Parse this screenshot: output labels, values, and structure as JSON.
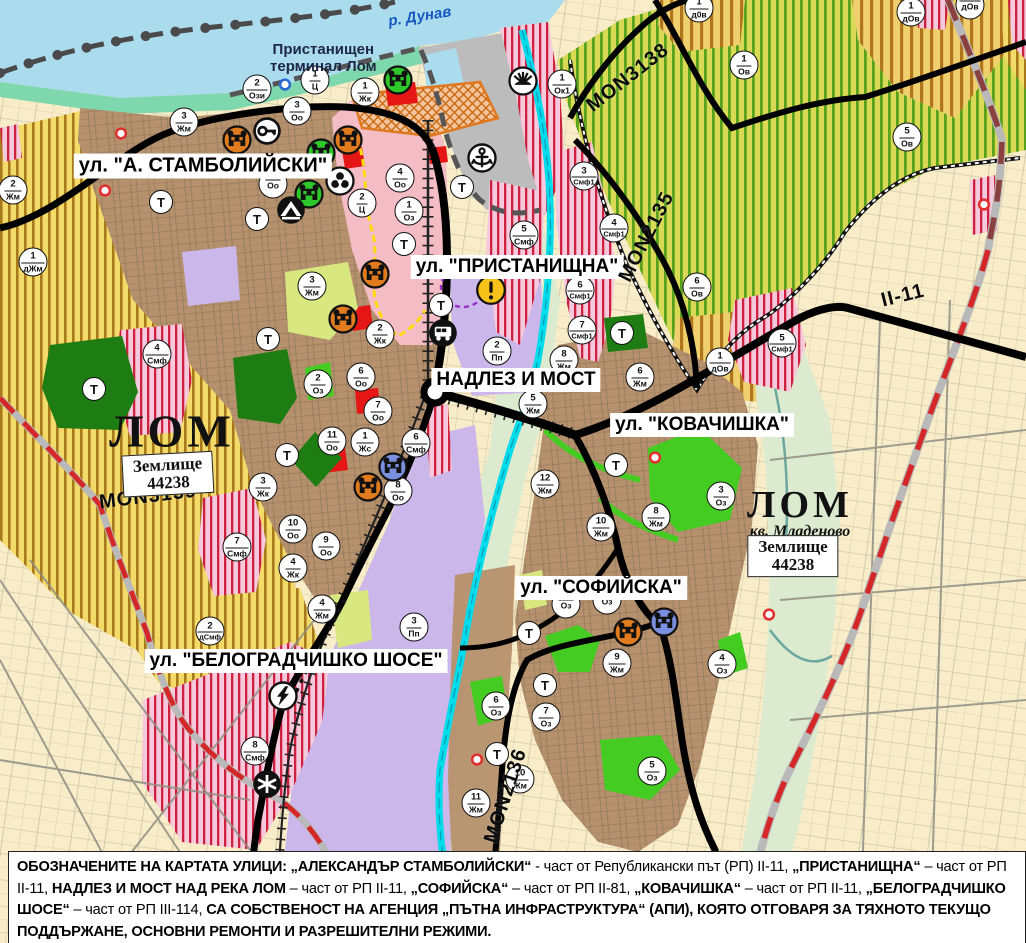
{
  "map_title": "Устройствен план на гр. Лом",
  "colors": {
    "water": "#aadcee",
    "river_cyan": "#00dcec",
    "coast_strip": "#7fd7ad",
    "city_brown": "#b6916d",
    "lavender_production": "#cbb7ea",
    "beige_farmland": "#f8edc8",
    "port_gray": "#bcbcbc",
    "center_pink": "#f4bcc4",
    "green_area": "#44cc22",
    "park_green": "#1e7d12",
    "pale_green": "#d8e77f",
    "floodplain": "#dcebcf",
    "red_accent": "#e51616",
    "yellow_zone": "#f3da69",
    "yellow_stripe": "#a87a1b",
    "vine_green_stripe": "#5aa21d",
    "smf_red_stripe": "#ce2140",
    "boundary_red": "#d42727",
    "historic_orange": "#e07820"
  },
  "water_label": {
    "text": "р. Дунав"
  },
  "port_label": {
    "line1": "Пристанищен",
    "line2": "терминал Лом"
  },
  "city_labels": [
    {
      "name": "ЛОМ",
      "sub": "",
      "x": 172,
      "y": 431,
      "size": 46
    },
    {
      "name": "ЛОМ",
      "sub": "кв. Младеново",
      "x": 800,
      "y": 512,
      "size": 38
    }
  ],
  "land_boxes": [
    {
      "line1": "Землище",
      "line2": "44238",
      "x": 168,
      "y": 474,
      "rot": -3
    },
    {
      "line1": "Землище",
      "line2": "44238",
      "x": 793,
      "y": 556,
      "rot": 0
    }
  ],
  "street_labels": [
    {
      "text": "ул. \"А. СТАМБОЛИЙСКИ\"",
      "x": 203,
      "y": 166,
      "fs": 20
    },
    {
      "text": "ул. \"ПРИСТАНИЩНА\"",
      "x": 517,
      "y": 267,
      "fs": 19
    },
    {
      "text": "НАДЛЕЗ И МОСТ",
      "x": 516,
      "y": 380,
      "fs": 19
    },
    {
      "text": "ул. \"КОВАЧИШКА\"",
      "x": 702,
      "y": 425,
      "fs": 19
    },
    {
      "text": "ул. \"СОФИЙСКА\"",
      "x": 601,
      "y": 588,
      "fs": 19
    },
    {
      "text": "ул. \"БЕЛОГРАДЧИШКО ШОСЕ\"",
      "x": 296,
      "y": 661,
      "fs": 19
    }
  ],
  "road_labels": [
    {
      "text": "MON3138",
      "x": 628,
      "y": 78,
      "rot": -38
    },
    {
      "text": "MON2135",
      "x": 647,
      "y": 237,
      "rot": -63
    },
    {
      "text": "MON3139",
      "x": 148,
      "y": 497,
      "rot": -7
    },
    {
      "text": "MON2136",
      "x": 506,
      "y": 796,
      "rot": -72
    },
    {
      "text": "II-11",
      "x": 903,
      "y": 296,
      "rot": -14
    }
  ],
  "zone_markers": [
    {
      "num": "2",
      "code": "Ози",
      "x": 257,
      "y": 89
    },
    {
      "num": "1",
      "code": "Ц",
      "x": 315,
      "y": 80
    },
    {
      "num": "1",
      "code": "Жк",
      "x": 365,
      "y": 92
    },
    {
      "num": "3",
      "code": "Оо",
      "x": 297,
      "y": 111
    },
    {
      "num": "3",
      "code": "Жм",
      "x": 184,
      "y": 122
    },
    {
      "num": "2",
      "code": "Жм",
      "x": 13,
      "y": 190
    },
    {
      "num": "1",
      "code": "дЖм",
      "x": 33,
      "y": 262
    },
    {
      "num": "4",
      "code": "Оо",
      "x": 400,
      "y": 178
    },
    {
      "num": "2",
      "code": "Ц",
      "x": 362,
      "y": 203
    },
    {
      "num": "1",
      "code": "Оз",
      "x": 409,
      "y": 211
    },
    {
      "num": "",
      "code": "Оо",
      "x": 273,
      "y": 184
    },
    {
      "num": "3",
      "code": "Жм",
      "x": 312,
      "y": 286
    },
    {
      "num": "1",
      "code": "Ок1",
      "x": 562,
      "y": 84
    },
    {
      "num": "3",
      "code": "Смф1",
      "x": 584,
      "y": 176
    },
    {
      "num": "4",
      "code": "Смф1",
      "x": 614,
      "y": 228
    },
    {
      "num": "5",
      "code": "Смф",
      "x": 524,
      "y": 235
    },
    {
      "num": "1",
      "code": "Ов",
      "x": 744,
      "y": 65
    },
    {
      "num": "5",
      "code": "Ов",
      "x": 907,
      "y": 137
    },
    {
      "num": "1",
      "code": "д0в",
      "x": 699,
      "y": 8
    },
    {
      "num": "1",
      "code": "дОв",
      "x": 911,
      "y": 12
    },
    {
      "num": "",
      "code": "дОв",
      "x": 970,
      "y": 5
    },
    {
      "num": "6",
      "code": "Ов",
      "x": 697,
      "y": 287
    },
    {
      "num": "1",
      "code": "дОв",
      "x": 720,
      "y": 362
    },
    {
      "num": "5",
      "code": "Смф1",
      "x": 782,
      "y": 343
    },
    {
      "num": "6",
      "code": "Смф1",
      "x": 580,
      "y": 290
    },
    {
      "num": "7",
      "code": "Смф1",
      "x": 582,
      "y": 330
    },
    {
      "num": "2",
      "code": "Пп",
      "x": 497,
      "y": 351
    },
    {
      "num": "8",
      "code": "Жм",
      "x": 564,
      "y": 360
    },
    {
      "num": "4",
      "code": "Смф",
      "x": 157,
      "y": 354
    },
    {
      "num": "2",
      "code": "Оз",
      "x": 318,
      "y": 384
    },
    {
      "num": "6",
      "code": "Оо",
      "x": 361,
      "y": 377
    },
    {
      "num": "2",
      "code": "Жк",
      "x": 380,
      "y": 334
    },
    {
      "num": "7",
      "code": "Оо",
      "x": 378,
      "y": 411
    },
    {
      "num": "11",
      "code": "Оо",
      "x": 332,
      "y": 441
    },
    {
      "num": "1",
      "code": "Жс",
      "x": 365,
      "y": 442
    },
    {
      "num": "6",
      "code": "Смф",
      "x": 416,
      "y": 443
    },
    {
      "num": "8",
      "code": "Оо",
      "x": 398,
      "y": 491
    },
    {
      "num": "3",
      "code": "Жк",
      "x": 263,
      "y": 487
    },
    {
      "num": "10",
      "code": "Оо",
      "x": 293,
      "y": 529
    },
    {
      "num": "9",
      "code": "Оо",
      "x": 326,
      "y": 546
    },
    {
      "num": "4",
      "code": "Жк",
      "x": 293,
      "y": 568
    },
    {
      "num": "7",
      "code": "Смф",
      "x": 237,
      "y": 547
    },
    {
      "num": "5",
      "code": "Жм",
      "x": 533,
      "y": 404
    },
    {
      "num": "6",
      "code": "Жм",
      "x": 640,
      "y": 377
    },
    {
      "num": "12",
      "code": "Жм",
      "x": 545,
      "y": 484
    },
    {
      "num": "10",
      "code": "Жм",
      "x": 601,
      "y": 527
    },
    {
      "num": "8",
      "code": "Жм",
      "x": 656,
      "y": 517
    },
    {
      "num": "3",
      "code": "Оз",
      "x": 721,
      "y": 496
    },
    {
      "num": "2",
      "code": "дСмф",
      "x": 210,
      "y": 631
    },
    {
      "num": "4",
      "code": "Жм",
      "x": 322,
      "y": 609
    },
    {
      "num": "3",
      "code": "Пп",
      "x": 414,
      "y": 627
    },
    {
      "num": "8",
      "code": "Смф",
      "x": 255,
      "y": 751
    },
    {
      "num": "",
      "code": "Оз",
      "x": 566,
      "y": 604
    },
    {
      "num": "",
      "code": "Оз",
      "x": 607,
      "y": 600
    },
    {
      "num": "6",
      "code": "Оз",
      "x": 496,
      "y": 706
    },
    {
      "num": "7",
      "code": "Оз",
      "x": 546,
      "y": 717
    },
    {
      "num": "9",
      "code": "Жм",
      "x": 617,
      "y": 663
    },
    {
      "num": "10",
      "code": "Жм",
      "x": 520,
      "y": 779
    },
    {
      "num": "11",
      "code": "Жм",
      "x": 476,
      "y": 803
    },
    {
      "num": "5",
      "code": "Оз",
      "x": 652,
      "y": 771
    },
    {
      "num": "4",
      "code": "Оз",
      "x": 722,
      "y": 664
    }
  ],
  "t_markers": {
    "label": "Т",
    "points": [
      [
        161,
        202
      ],
      [
        257,
        219
      ],
      [
        404,
        244
      ],
      [
        462,
        187
      ],
      [
        268,
        339
      ],
      [
        94,
        389
      ],
      [
        287,
        455
      ],
      [
        441,
        305
      ],
      [
        622,
        333
      ],
      [
        616,
        465
      ],
      [
        529,
        633
      ],
      [
        545,
        685
      ],
      [
        497,
        754
      ]
    ]
  },
  "icon_markers": [
    {
      "type": "monument",
      "name": "cultural-monument-icon",
      "color": "orange",
      "x": 237,
      "y": 140
    },
    {
      "type": "monument",
      "name": "cultural-monument-icon",
      "color": "orange",
      "x": 348,
      "y": 140
    },
    {
      "type": "monument",
      "name": "cultural-monument-icon",
      "color": "green",
      "x": 321,
      "y": 153
    },
    {
      "type": "monument",
      "name": "cultural-monument-icon",
      "color": "green",
      "x": 309,
      "y": 194
    },
    {
      "type": "monument",
      "name": "cultural-monument-icon",
      "color": "green",
      "x": 398,
      "y": 80
    },
    {
      "type": "monument",
      "name": "cultural-monument-icon",
      "color": "orange",
      "x": 375,
      "y": 274
    },
    {
      "type": "monument",
      "name": "cultural-monument-icon",
      "color": "orange",
      "x": 343,
      "y": 319
    },
    {
      "type": "monument",
      "name": "cultural-monument-icon",
      "color": "orange",
      "x": 368,
      "y": 487
    },
    {
      "type": "monument",
      "name": "cultural-monument-icon",
      "color": "blue",
      "x": 393,
      "y": 467
    },
    {
      "type": "monument",
      "name": "cultural-monument-icon",
      "color": "orange",
      "x": 628,
      "y": 632
    },
    {
      "type": "monument",
      "name": "cultural-monument-icon",
      "color": "blue",
      "x": 664,
      "y": 622
    },
    {
      "type": "key",
      "name": "key-icon",
      "color": "",
      "x": 267,
      "y": 131
    },
    {
      "type": "trefoil",
      "name": "trefoil-icon",
      "color": "",
      "x": 340,
      "y": 181
    },
    {
      "type": "tunnel",
      "name": "tunnel-icon",
      "color": "",
      "x": 291,
      "y": 210
    },
    {
      "type": "anchor",
      "name": "anchor-icon",
      "color": "",
      "x": 482,
      "y": 158
    },
    {
      "type": "sun",
      "name": "sun-resort-icon",
      "color": "",
      "x": 523,
      "y": 81
    },
    {
      "type": "warning",
      "name": "warning-icon",
      "color": "",
      "x": 491,
      "y": 290
    },
    {
      "type": "bus",
      "name": "bus-station-icon",
      "color": "",
      "x": 443,
      "y": 333
    },
    {
      "type": "lightning",
      "name": "lightning-icon",
      "color": "",
      "x": 283,
      "y": 696
    },
    {
      "type": "crossing",
      "name": "railway-crossing-icon",
      "color": "",
      "x": 267,
      "y": 784
    }
  ],
  "dot_markers": [
    {
      "color": "red",
      "x": 121,
      "y": 136
    },
    {
      "color": "red",
      "x": 105,
      "y": 193
    },
    {
      "color": "red",
      "x": 655,
      "y": 460
    },
    {
      "color": "red",
      "x": 477,
      "y": 762
    },
    {
      "color": "red",
      "x": 769,
      "y": 617
    },
    {
      "color": "red",
      "x": 984,
      "y": 207
    },
    {
      "color": "blue",
      "x": 285,
      "y": 87
    }
  ],
  "footer": {
    "segments": [
      {
        "text": "ОБОЗНАЧЕНИТЕ НА КАРТАТА УЛИЦИ: ",
        "bold": true
      },
      {
        "text": "„АЛЕКСАНДЪР СТАМБОЛИЙСКИ“",
        "bold": true
      },
      {
        "text": " - част от Републикански път (РП) II-11, ",
        "bold": false
      },
      {
        "text": "„ПРИСТАНИЩНА“",
        "bold": true
      },
      {
        "text": " – част от РП II-11, ",
        "bold": false
      },
      {
        "text": "НАДЛЕЗ И МОСТ НАД РЕКА ЛОМ",
        "bold": true
      },
      {
        "text": " – част от РП II-11, ",
        "bold": false
      },
      {
        "text": "„СОФИЙСКА“",
        "bold": true
      },
      {
        "text": " – част от РП II-81, ",
        "bold": false
      },
      {
        "text": "„КОВАЧИШКА“",
        "bold": true
      },
      {
        "text": " – част от РП II-11, ",
        "bold": false
      },
      {
        "text": "„БЕЛОГРАДЧИШКО ШОСЕ“",
        "bold": true
      },
      {
        "text": " – част от РП III-114, ",
        "bold": false
      },
      {
        "text": "СА СОБСТВЕНОСТ НА АГЕНЦИЯ „ПЪТНА ИНФРАСТРУКТУРА“ (АПИ), КОЯТО ОТГОВАРЯ ЗА ТЯХНОТО ТЕКУЩО ПОДДЪРЖАНЕ, ОСНОВНИ РЕМОНТИ И РАЗРЕШИТЕЛНИ РЕЖИМИ.",
        "bold": true
      }
    ]
  }
}
